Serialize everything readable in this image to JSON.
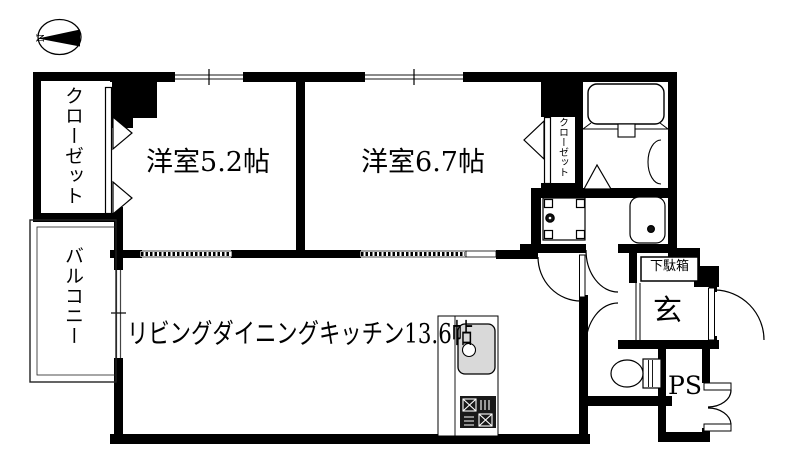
{
  "floor_plan": {
    "compass": {
      "north_label": "N"
    },
    "rooms": {
      "closet_left": {
        "label": "クローゼット"
      },
      "balcony": {
        "label": "バルコニー"
      },
      "bedroom_1": {
        "label": "洋室5.2帖",
        "size_tatami": 5.2
      },
      "bedroom_2": {
        "label": "洋室6.7帖",
        "size_tatami": 6.7
      },
      "closet_bedroom2": {
        "label": "クローゼット"
      },
      "living_dining_kitchen": {
        "label": "リビングダイニングキッチン13.6帖",
        "size_tatami": 13.6
      },
      "shoe_cabinet": {
        "label": "下駄箱"
      },
      "entrance": {
        "label": "玄"
      },
      "pipe_space": {
        "label": "PS"
      }
    },
    "fixtures": [
      "bathtub",
      "washing-machine-pan",
      "washbasin",
      "toilet",
      "kitchen-sink",
      "gas-stove"
    ],
    "colors": {
      "wall": "#000000",
      "background": "#ffffff",
      "sink_fill": "#d9d9d9"
    }
  }
}
